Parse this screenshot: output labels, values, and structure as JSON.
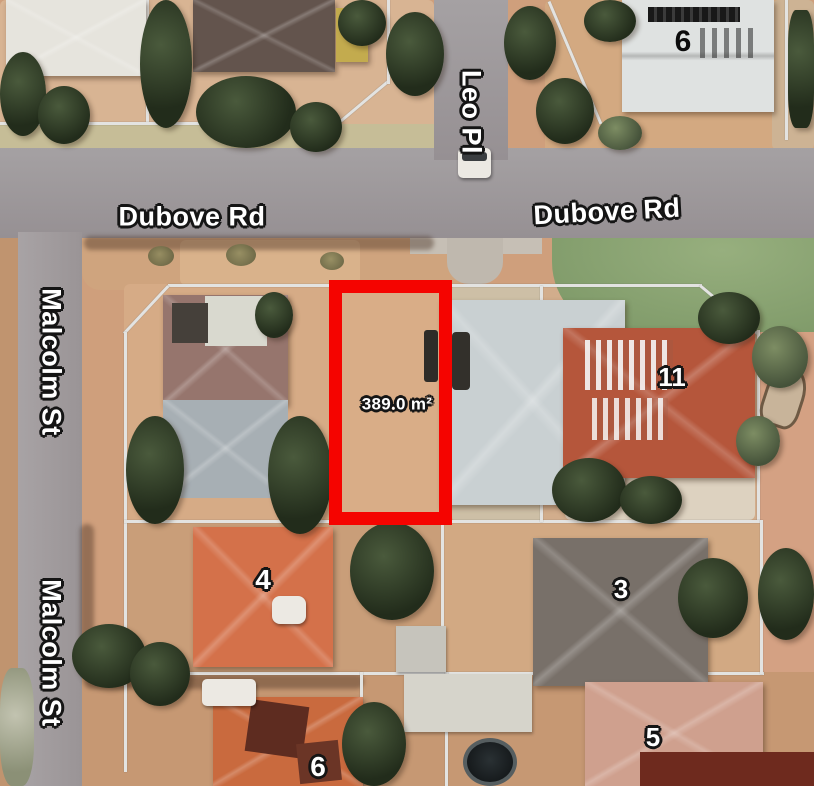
{
  "map": {
    "roads": {
      "leo_pl": "Leo Pl",
      "dubove_rd_west": "Dubove Rd",
      "dubove_rd_east": "Dubove Rd",
      "malcolm_st_north": "Malcolm St",
      "malcolm_st_south": "Malcolm St"
    },
    "lots": {
      "lot_6_top": "6",
      "lot_11": "11",
      "lot_4": "4",
      "lot_3": "3",
      "lot_5": "5",
      "lot_6_bottom": "6"
    },
    "highlight": {
      "area": "389.0 m²",
      "outline_color": "#f50400"
    },
    "colors": {
      "boundary_line": "#e3e3e1",
      "road": "#9b9597",
      "grass": "#8fa878"
    }
  }
}
